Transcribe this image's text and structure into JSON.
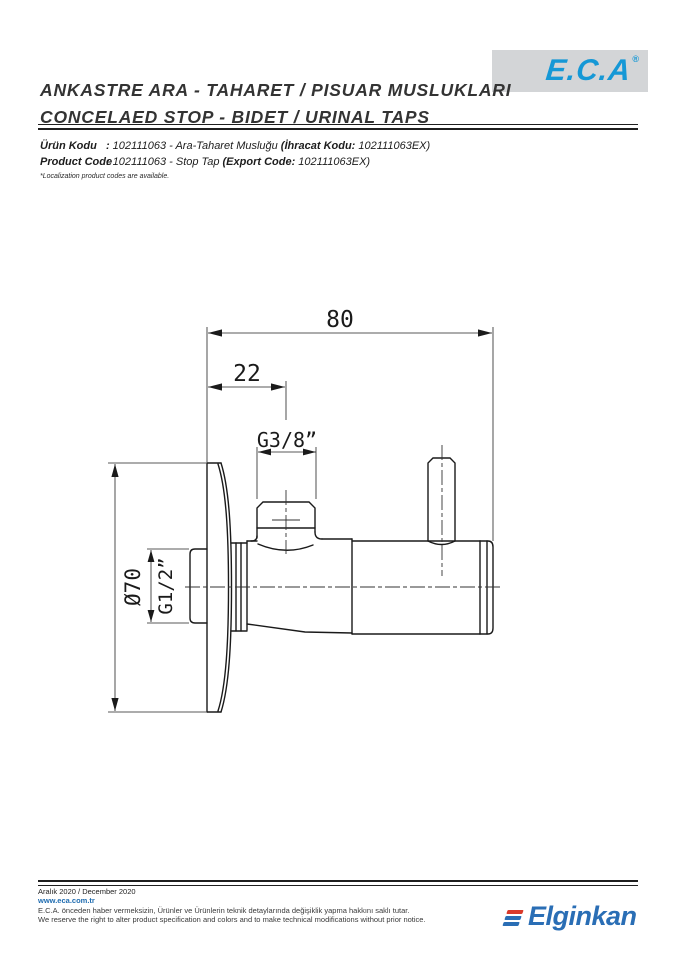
{
  "header": {
    "title_line1": "ANKASTRE ARA - TAHARET / PISUAR MUSLUKLARI",
    "title_line2": "CONCELAED STOP - BIDET / URINAL TAPS",
    "brand": "E.C.A",
    "brand_registered": "®"
  },
  "product": {
    "rows": [
      {
        "label": "Ürün Kodu",
        "sep": ":",
        "value": "102111063 - Ara-Taharet Musluğu",
        "paren_label": "(İhracat Kodu:",
        "paren_value": " 102111063EX)"
      },
      {
        "label": "Product Code",
        "sep": ":",
        "value": "102111063 - Stop Tap",
        "paren_label": "(Export Code:",
        "paren_value": " 102111063EX)"
      }
    ],
    "note": "*Localization product codes are available."
  },
  "drawing": {
    "total_width": "80",
    "port_offset": "22",
    "top_thread": "G3/8”",
    "flange_diameter": "Ø70",
    "inlet_thread": "G1/2”"
  },
  "footer": {
    "date": "Aralık 2020 / December 2020",
    "website": "www.eca.com.tr",
    "disclaimer_tr": "E.C.A. önceden haber vermeksizin, Ürünler ve Ürünlerin teknik detaylarında değişiklik yapma hakkını saklı tutar.",
    "disclaimer_en": "We reserve the right to alter product specification and colors and to make technical modifications without prior notice.",
    "brand": "Elginkan"
  },
  "colors": {
    "eca_blue": "#1598d6",
    "elginkan_blue": "#2a6eb5",
    "elginkan_red": "#d93a2b",
    "logo_bg": "#d3d5d7"
  }
}
